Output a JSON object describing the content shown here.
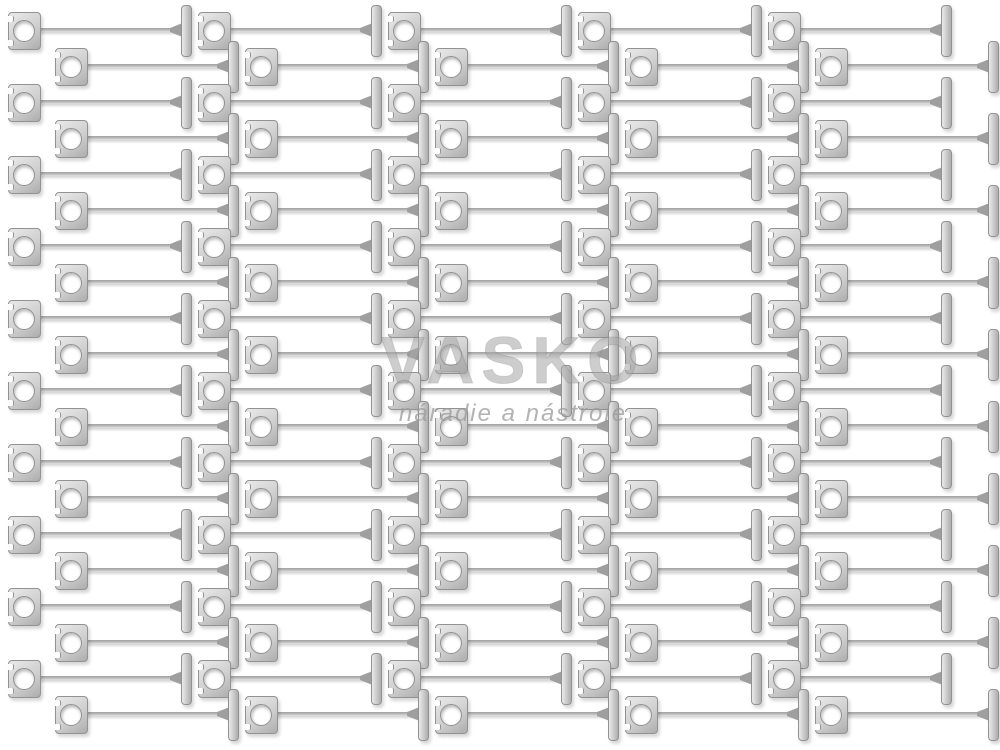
{
  "image": {
    "type": "product-photo",
    "subject": "Galvanized metal terrace decking fastening clips arranged in offset rows on white background",
    "background_color": "#ffffff"
  },
  "watermark": {
    "brand": "VASKO",
    "tagline": "náradie a nástroje",
    "brand_color": "#a6a6a6",
    "tagline_color": "#9a9a9a"
  },
  "product_grid": {
    "rows": 20,
    "units_per_row": 5,
    "row_start_center_y": 30,
    "row_spacing": 36,
    "row_offsets_x": [
      8,
      55
    ],
    "unit_pitch": 190,
    "plate": {
      "width": 31,
      "height": 36,
      "hole_diameter": 20,
      "corner_radius": 4
    },
    "stem": {
      "length": 146,
      "thickness": 4
    },
    "tbar": {
      "width": 9,
      "height": 50,
      "offset_from_plate_left": 173
    },
    "colors": {
      "metal_light": "#eaeaea",
      "metal_mid": "#cfcfcf",
      "metal_dark": "#adadad",
      "edge": "#929292",
      "stem": "#9f9f9f",
      "shadow": "rgba(0,0,0,0.16)"
    }
  }
}
